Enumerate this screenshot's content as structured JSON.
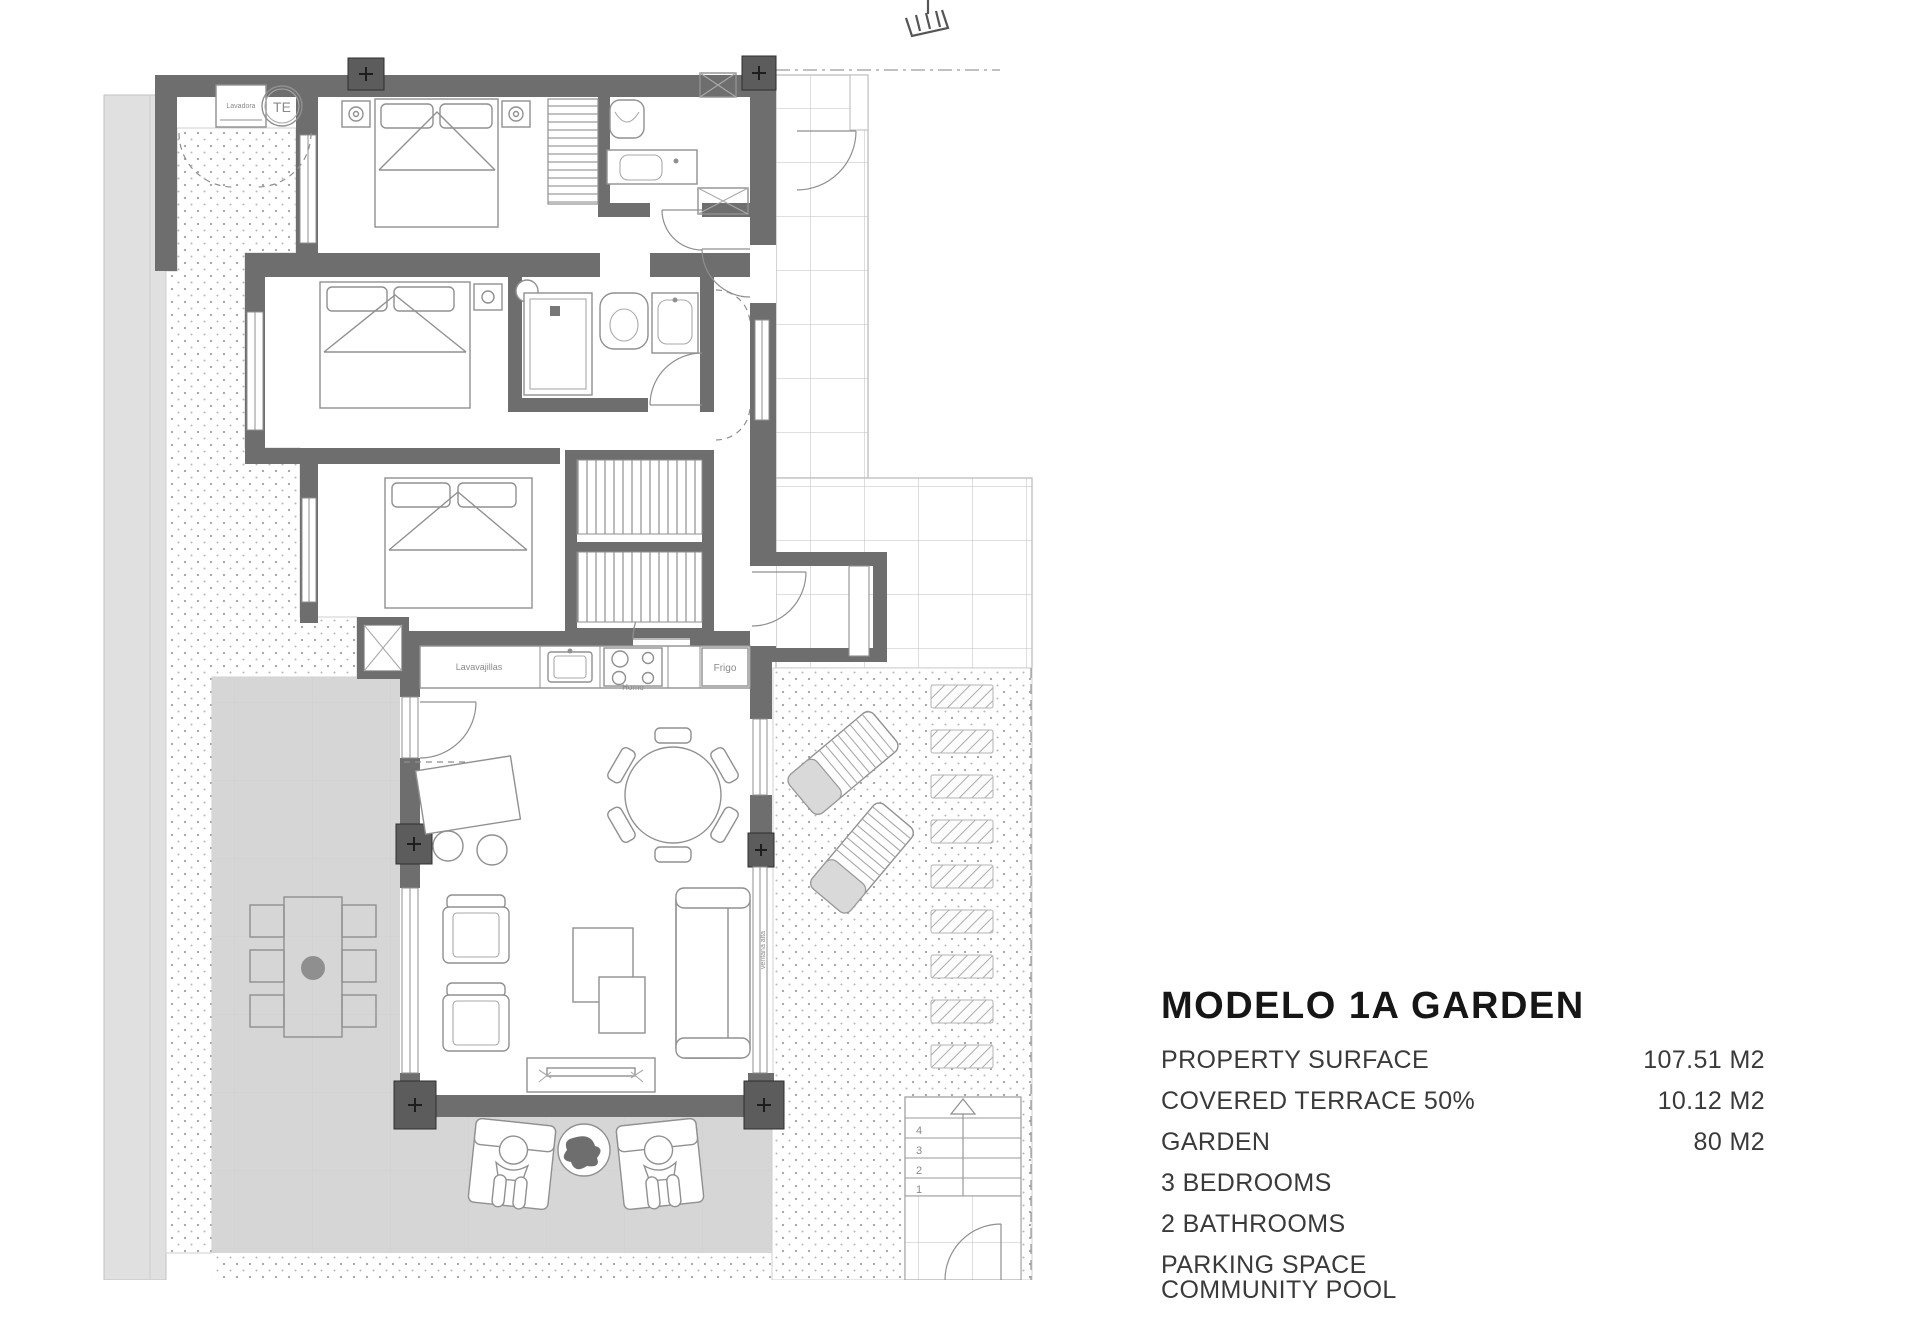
{
  "header": {
    "title": "MODELO 1A GARDEN"
  },
  "specs": {
    "rows": [
      {
        "label": "PROPERTY SURFACE",
        "value": "107.51 M2"
      },
      {
        "label": "COVERED TERRACE 50%",
        "value": "10.12 M2"
      },
      {
        "label": "GARDEN",
        "value": "80 M2"
      },
      {
        "label": "3 BEDROOMS",
        "value": ""
      },
      {
        "label": "2 BATHROOMS",
        "value": ""
      },
      {
        "label": "PARKING SPACE",
        "value": ""
      },
      {
        "label": "COMMUNITY POOL",
        "value": ""
      }
    ]
  },
  "plan": {
    "labels": {
      "washer": "Lavadora",
      "water_heater": "TE",
      "dishwasher": "Lavavajillas",
      "oven": "Horno",
      "fridge": "Frigo",
      "window_note": "ventana alta"
    },
    "stair_steps": [
      "4",
      "3",
      "2",
      "1"
    ]
  },
  "colors": {
    "wall": "#6e6e6e",
    "column": "#5c5c5c",
    "garden_slab": "#d6d6d6",
    "boundary_band": "#e0e0e0",
    "furniture_line": "#909090",
    "title_ink": "#161616",
    "label_ink": "#3a3a3a"
  }
}
